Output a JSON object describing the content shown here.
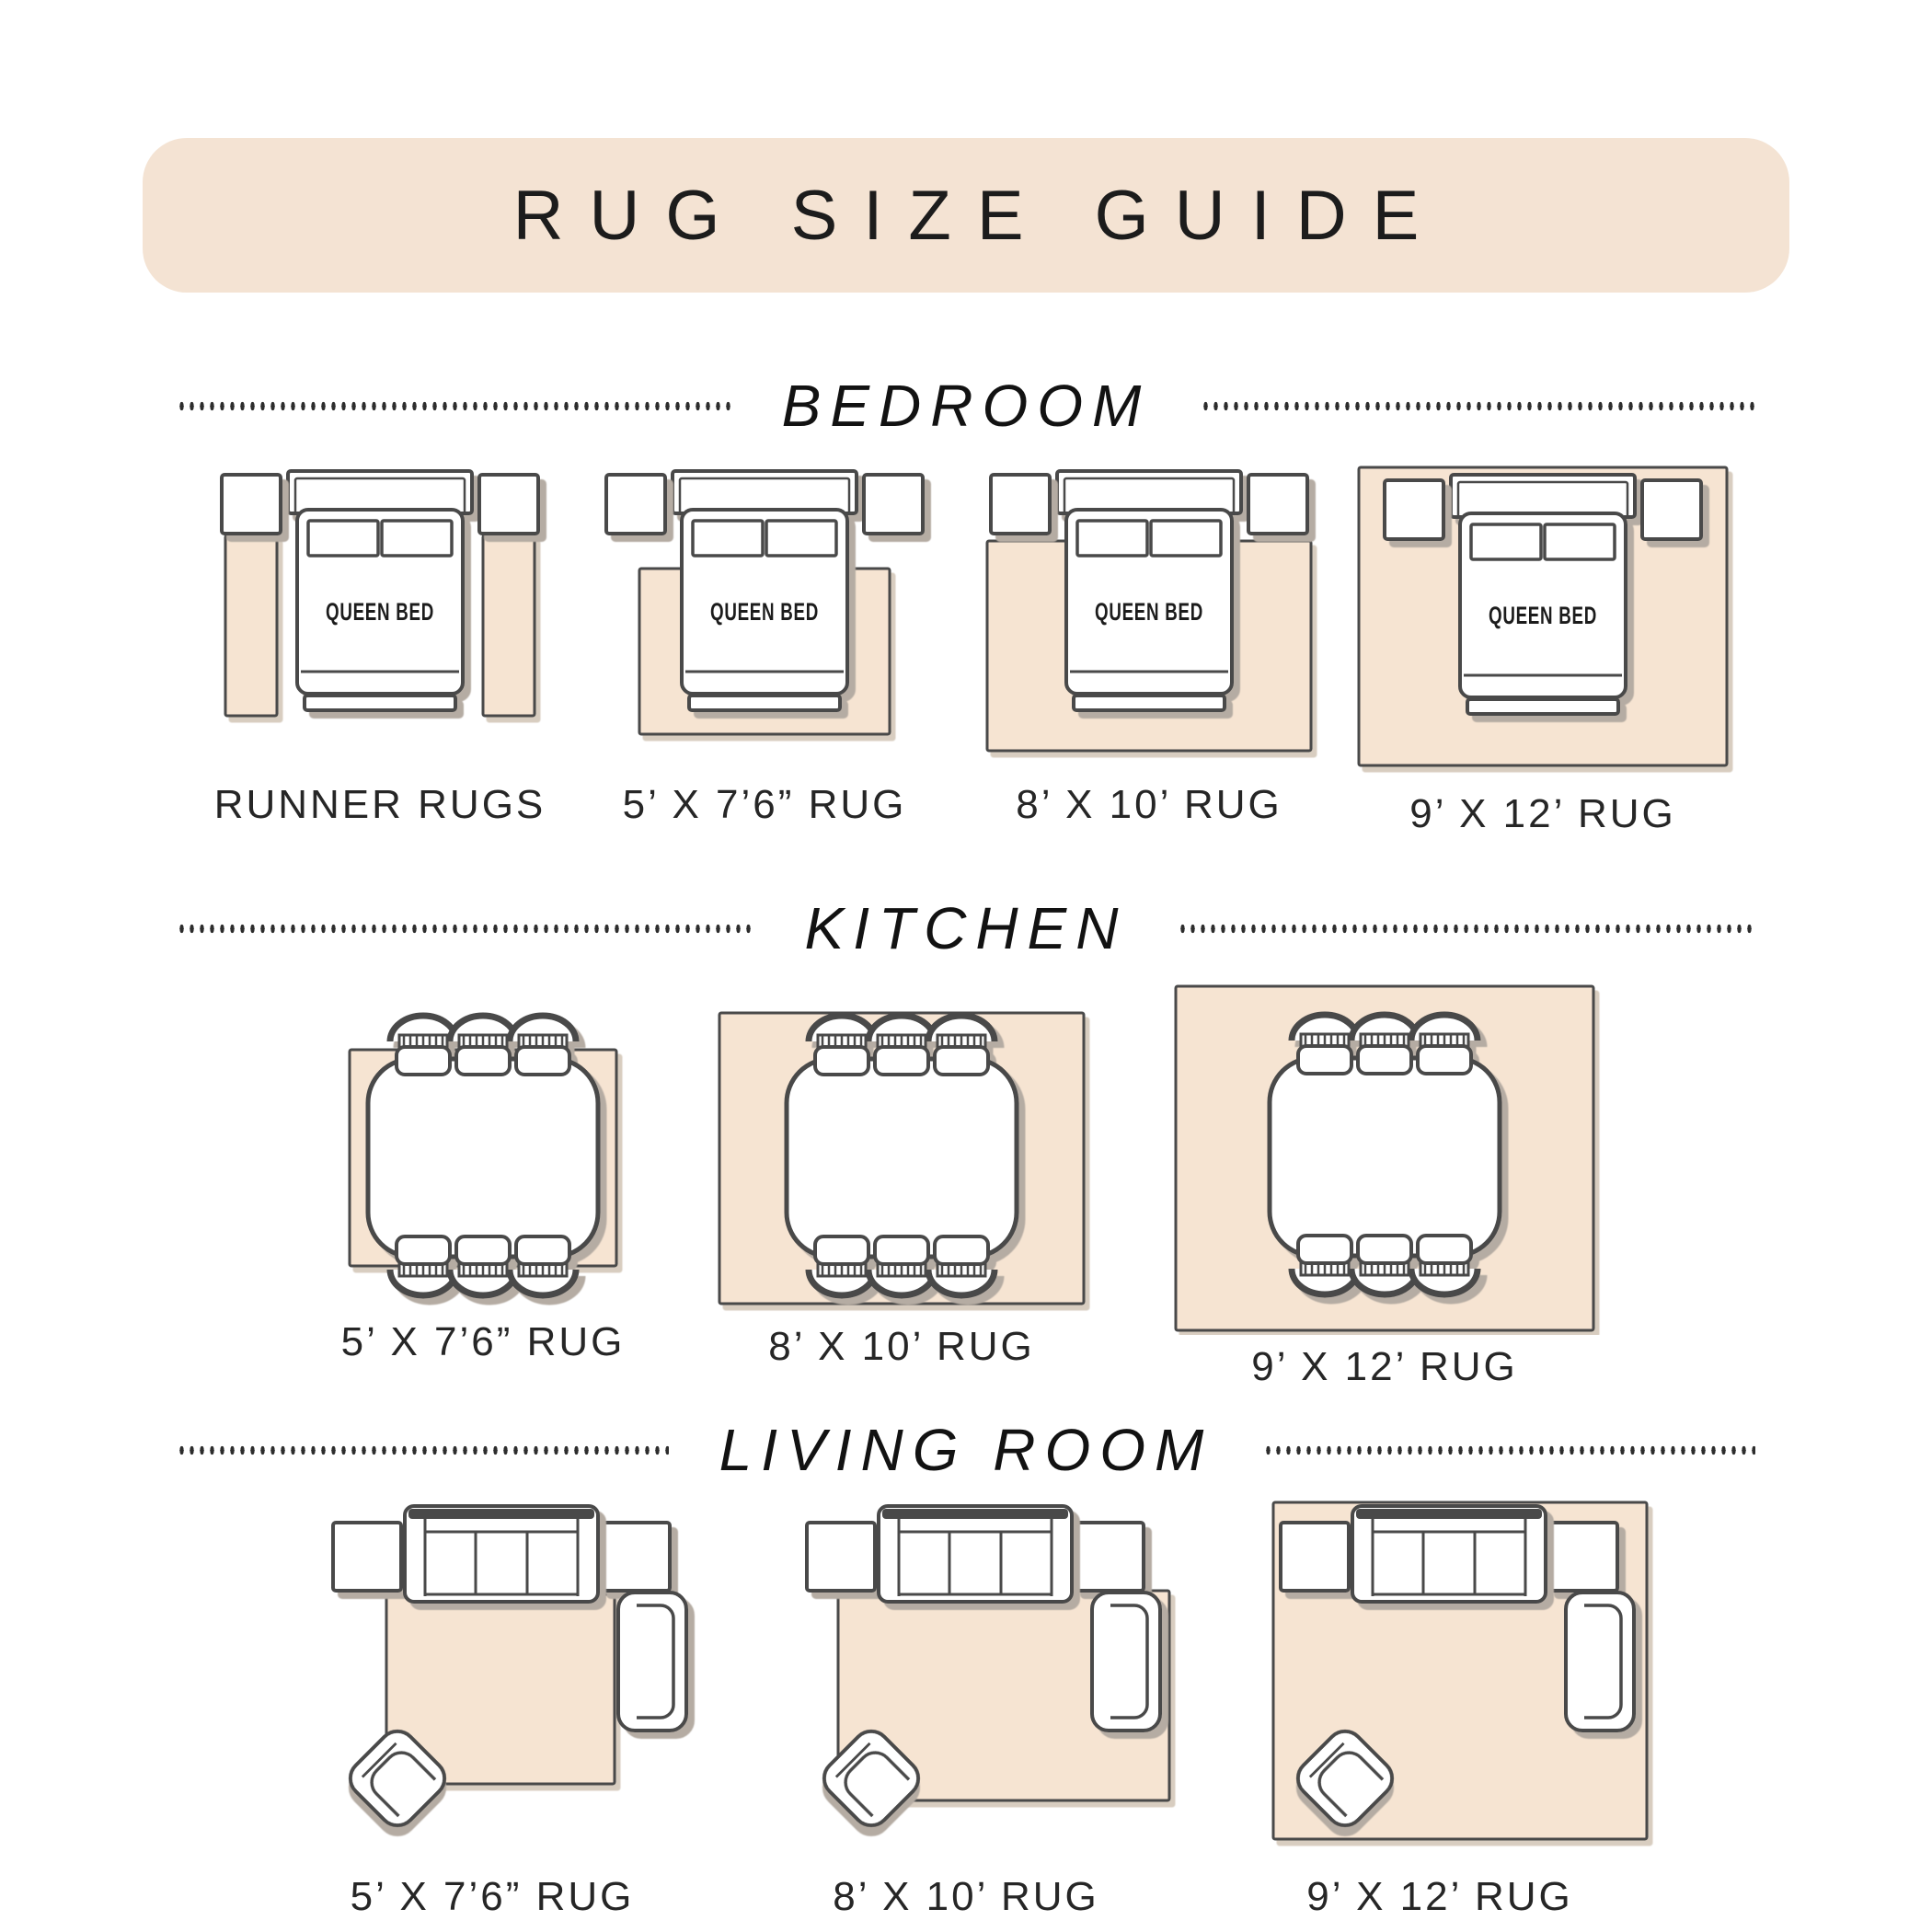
{
  "title": "RUG SIZE GUIDE",
  "colors": {
    "banner_fill": "#f4e3d3",
    "rug_fill": "#f6e4d2",
    "outline": "#4a4a4a",
    "furniture_shadow": "#b5aca3",
    "rug_shadow": "#d8cdc0",
    "text": "#1c1c1c"
  },
  "sections": [
    {
      "name": "BEDROOM",
      "bed_label": "QUEEN BED",
      "items": [
        {
          "label": "RUNNER RUGS"
        },
        {
          "label": "5’ X 7’6” RUG"
        },
        {
          "label": "8’ X 10’ RUG"
        },
        {
          "label": "9’ X 12’ RUG"
        }
      ]
    },
    {
      "name": "KITCHEN",
      "items": [
        {
          "label": "5’ X 7’6” RUG"
        },
        {
          "label": "8’ X 10’ RUG"
        },
        {
          "label": "9’ X 12’ RUG"
        }
      ]
    },
    {
      "name": "LIVING ROOM",
      "items": [
        {
          "label": "5’ X 7’6” RUG"
        },
        {
          "label": "8’ X 10’ RUG"
        },
        {
          "label": "9’ X 12’ RUG"
        }
      ]
    }
  ]
}
